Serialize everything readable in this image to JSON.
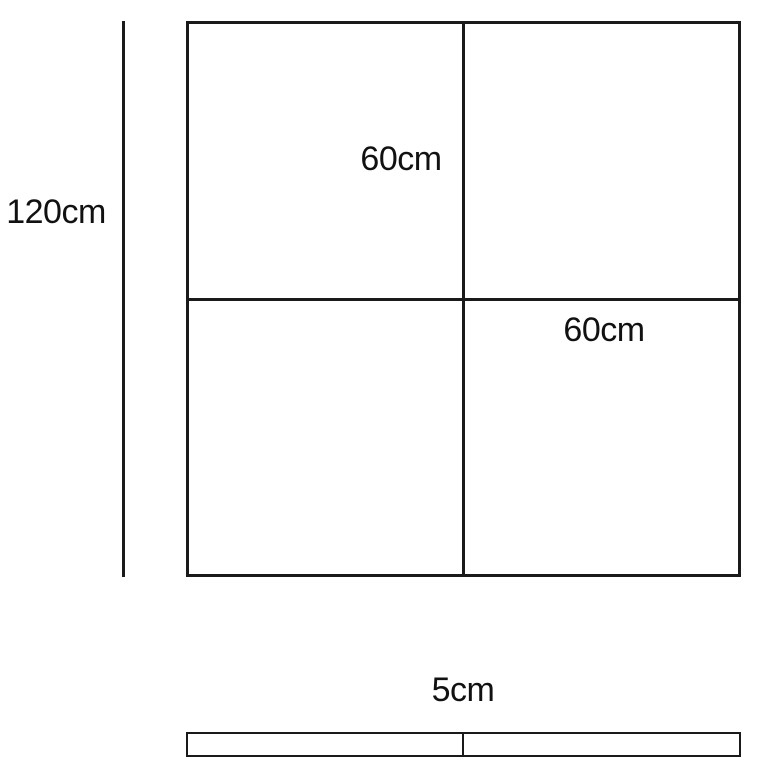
{
  "diagram": {
    "type": "dimensioned-technical-drawing",
    "colors": {
      "background": "#ffffff",
      "line": "#1a1a1a",
      "text": "#111111"
    },
    "labels": {
      "overall_height": "120cm",
      "upper_panel": "60cm",
      "lower_panel": "60cm",
      "depth": "5cm"
    }
  }
}
